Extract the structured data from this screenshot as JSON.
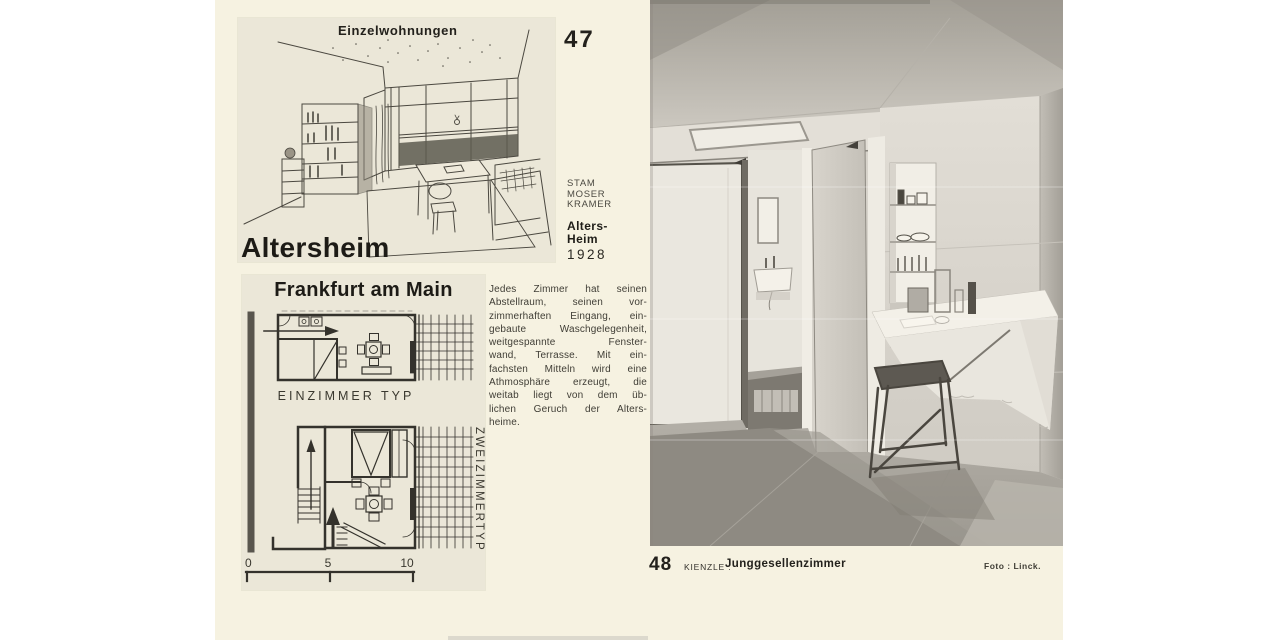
{
  "colors": {
    "page_cream": "#f6f2e1",
    "panel_paper": "#ebe7d8",
    "ink": "#23211c",
    "photo_gray_wall": "#dcd8d0",
    "photo_gray_floor": "#a9a59d"
  },
  "plate47": {
    "number": "47",
    "panel_heading": "Einzelwohnungen",
    "panel_title": "Altersheim",
    "architects": "STAM\nMOSER\nKRAMER",
    "work": "Alters-\nHeim",
    "year": "1928"
  },
  "frankfurt": {
    "heading": "Frankfurt am Main",
    "plan_one_label": "EINZIMMER TYP",
    "plan_two_label": "ZWEIZIMMERTYP",
    "scale_marks": {
      "zero": "0",
      "five": "5",
      "ten": "10"
    }
  },
  "body_text": "Jedes Zimmer hat seinen\nAbstellraum, seinen vor-\nzimmerhaften Eingang, ein-\ngebaute Waschgelegenheit,\nweitgespannte Fenster-\nwand, Terrasse. Mit ein-\nfachsten Mitteln wird eine\nAthmosphäre erzeugt, die\nweitab liegt von dem üb-\nlichen Geruch der Alters-\nheime.",
  "plate48": {
    "number": "48",
    "author": "KIENZLE :",
    "title": "Junggesellenzimmer",
    "photo_credit": "Foto : Linck."
  }
}
